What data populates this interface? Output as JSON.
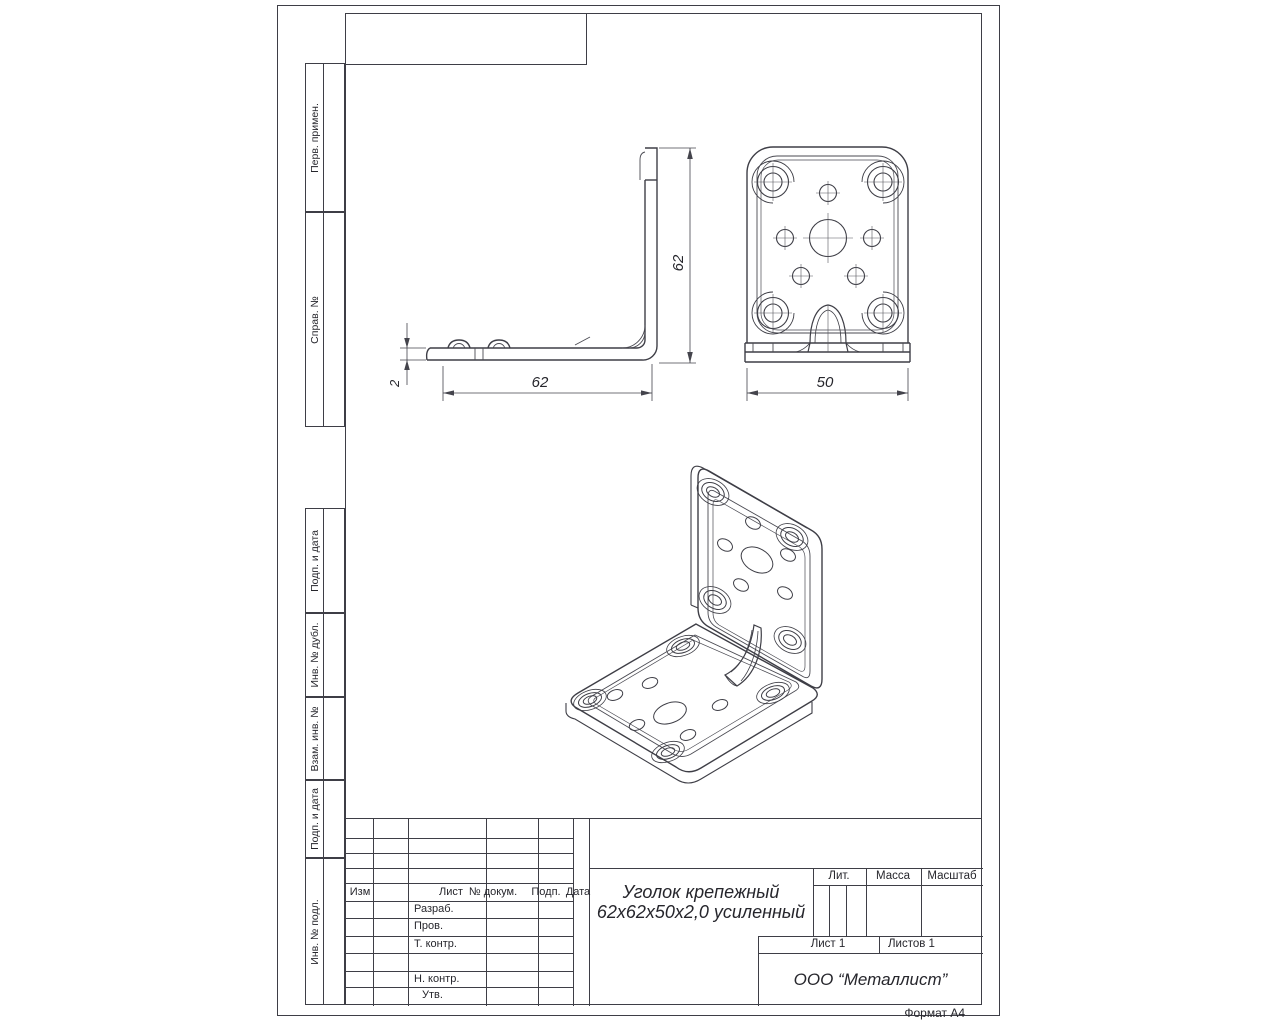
{
  "margin_labels": [
    {
      "label": "Перв. примен."
    },
    {
      "label": "Справ. №"
    },
    {
      "label": "Подп. и дата"
    },
    {
      "label": "Инв. № дубл."
    },
    {
      "label": "Взам. инв. №"
    },
    {
      "label": "Подп. и дата"
    },
    {
      "label": "Инв. № подл."
    }
  ],
  "title_block": {
    "header": {
      "izm": "Изм",
      "list": "Лист",
      "doc": "№ докум.",
      "podp": "Подп.",
      "data": "Дата"
    },
    "rows": {
      "razrab": "Разраб.",
      "prov": "Пров.",
      "tkontr": "Т. контр.",
      "nkontr": "Н. контр.",
      "utv": "Утв."
    },
    "part_name_line1": "Уголок крепежный",
    "part_name_line2": "62х62х50х2,0 усиленный",
    "lit": "Лит.",
    "mass": "Масса",
    "scale": "Масштаб",
    "sheet": "Лист 1",
    "sheets": "Листов 1",
    "company": "ООО “Металлист”"
  },
  "sheet": {
    "format": "Формат А4"
  },
  "dimensions": {
    "side_width": "62",
    "side_height": "62",
    "thickness": "2",
    "front_width": "50"
  }
}
